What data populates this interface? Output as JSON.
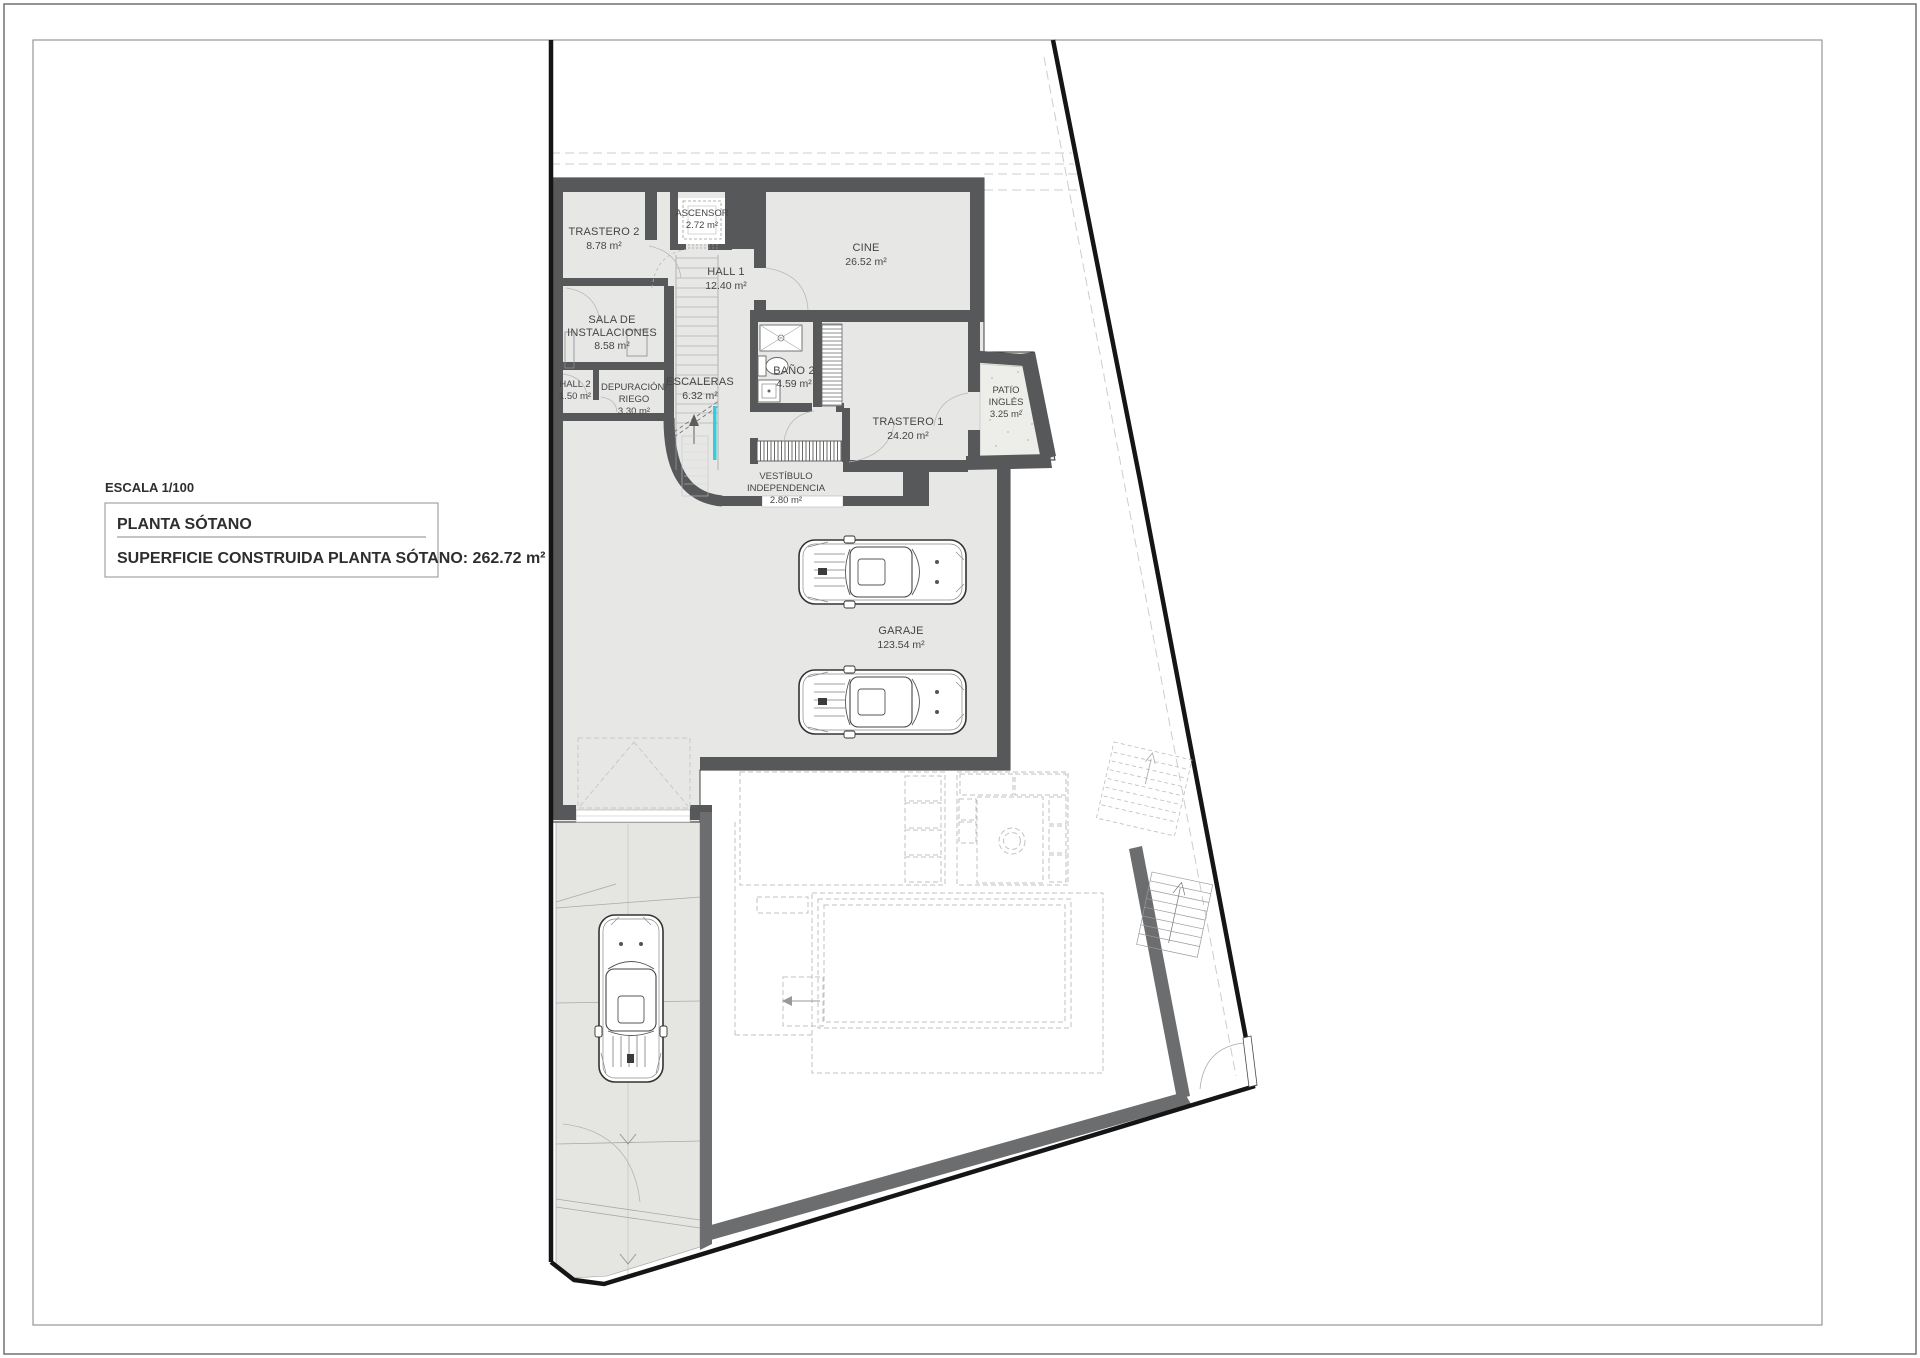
{
  "title_block": {
    "scale_label": "ESCALA 1/100",
    "plan_name": "PLANTA SÓTANO",
    "area_label": "SUPERFICIE CONSTRUIDA PLANTA SÓTANO: 262.72 m²"
  },
  "rooms": {
    "trastero2": {
      "name": "TRASTERO 2",
      "area": "8.78 m²"
    },
    "ascensor": {
      "name": "ASCENSOR",
      "area": "2.72 m²"
    },
    "hall1": {
      "name": "HALL 1",
      "area": "12.40 m²"
    },
    "cine": {
      "name": "CINE",
      "area": "26.52 m²"
    },
    "sala": {
      "name1": "SALA DE",
      "name2": "INSTALACIONES",
      "area": "8.58 m²"
    },
    "hall2": {
      "name": "HALL 2",
      "area": "1.50 m²"
    },
    "depuracion": {
      "name1": "DEPURACIÓN/",
      "name2": "RIEGO",
      "area": "3.30 m²"
    },
    "escaleras": {
      "name": "ESCALERAS",
      "area": "6.32 m²"
    },
    "bano2": {
      "name": "BAÑO 2",
      "area": "4.59 m²"
    },
    "trastero1": {
      "name": "TRASTERO 1",
      "area": "24.20 m²"
    },
    "patio": {
      "name1": "PATIO",
      "name2": "INGLÉS",
      "area": "3.25 m²"
    },
    "vestibulo": {
      "name1": "VESTÍBULO",
      "name2": "INDEPENDENCIA",
      "area": "2.80 m²"
    },
    "garaje": {
      "name": "GARAJE",
      "area": "123.54 m²"
    }
  },
  "colors": {
    "wall": "#57585a",
    "garden_wall": "#6c6d6f",
    "room_fill": "#e7e7e6",
    "driveway_fill": "#e5e6e1",
    "patio_fill": "#ededea",
    "boundary": "#151515",
    "section_cyan": "#35ccdc",
    "dashed_projection": "#cdcdcd"
  }
}
